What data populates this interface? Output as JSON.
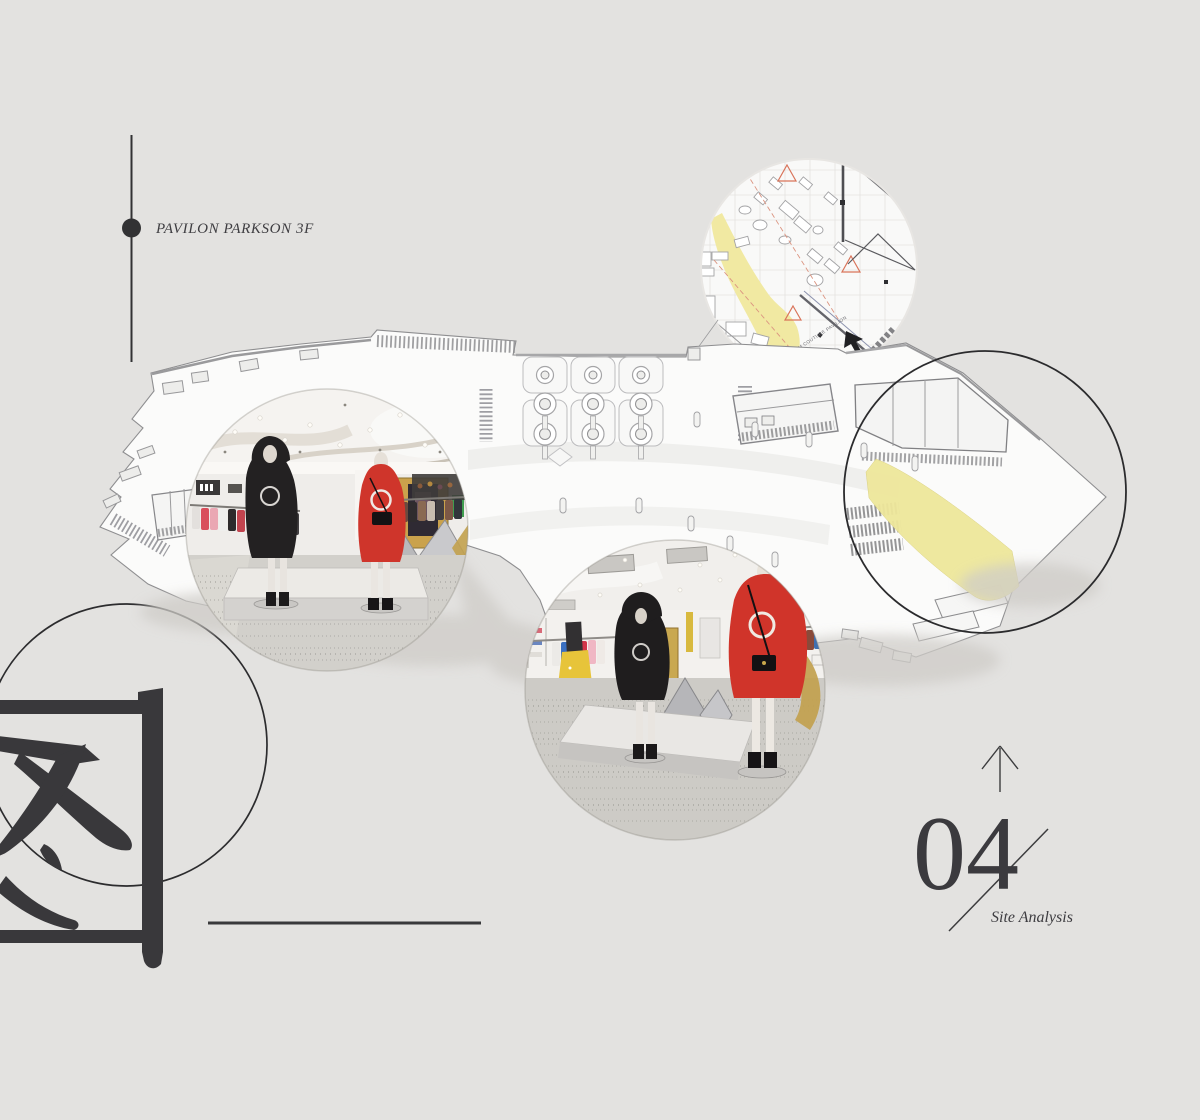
{
  "canvas": {
    "background_color": "#e3e2e0",
    "ink_color": "#3a393c",
    "highlight_color": "#efe79c",
    "accent_red": "#d9745a"
  },
  "header": {
    "project_label": "PAVILON PARKSON 3F"
  },
  "watermark": {
    "character": "图"
  },
  "plan_inset": {
    "annotation_label": "ENTRANCE FROM COUTURE PAVILION"
  },
  "section_marker": {
    "number": "04",
    "caption": "Site Analysis",
    "arrow_icon": "arrow-up-icon"
  }
}
